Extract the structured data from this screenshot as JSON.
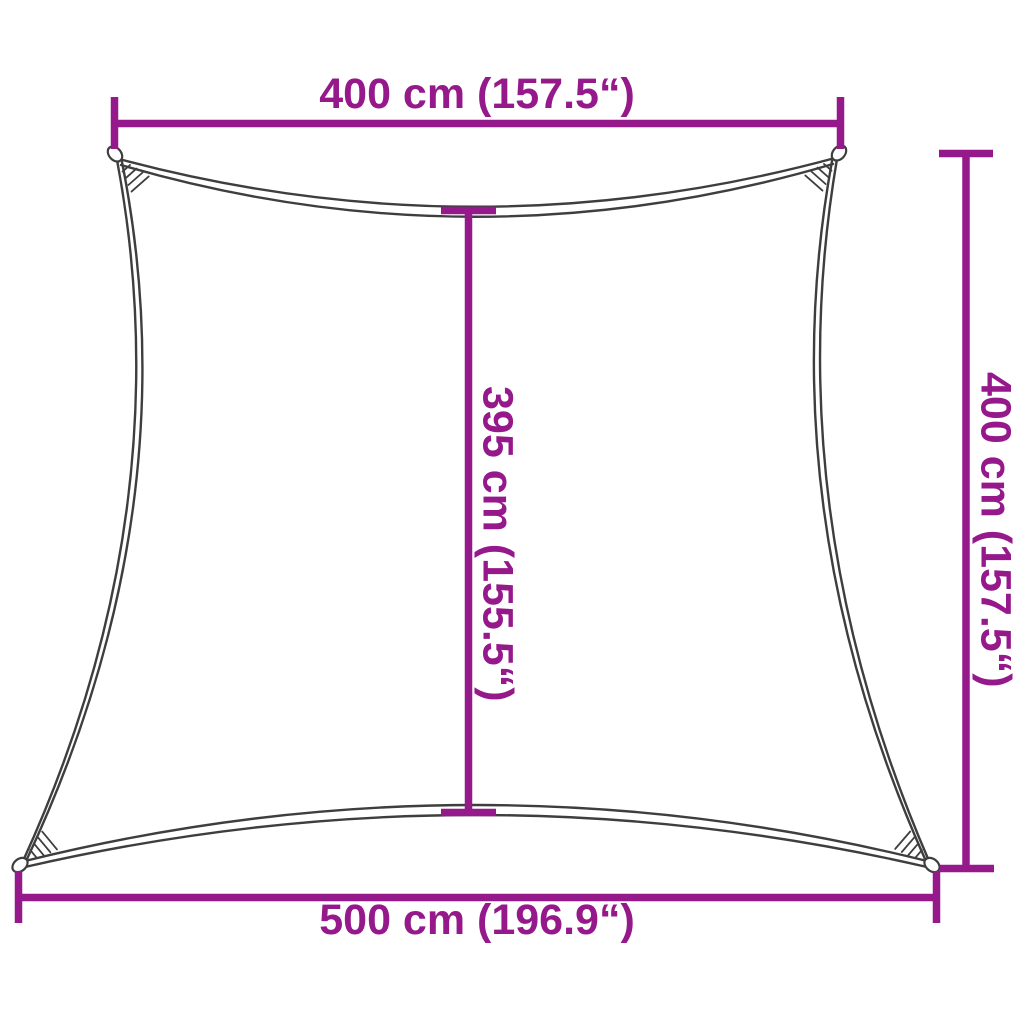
{
  "diagram": {
    "kind": "shade-sail-dimension-drawing",
    "background_color": "#ffffff",
    "accent_color": "#96198C",
    "outline_color": "#3E3E3E",
    "dimensions": {
      "top": {
        "label": "400 cm (157.5“)"
      },
      "right": {
        "label": "400 cm (157.5“)"
      },
      "middle": {
        "label": "395 cm (155.5“)"
      },
      "bottom": {
        "label": "500 cm (196.9“)"
      }
    }
  }
}
